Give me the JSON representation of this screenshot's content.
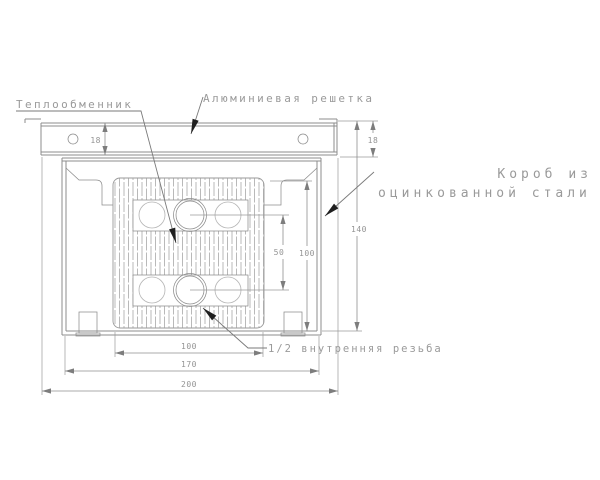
{
  "drawing": {
    "labels": {
      "heat_exchanger": "Теплообменник",
      "aluminum_grille": "Алюминиевая решетка",
      "steel_box_line1": "Короб из",
      "steel_box_line2": "оцинкованной стали",
      "thread": "1/2 внутренняя резьба"
    },
    "dimensions": {
      "grille_height_left": "18",
      "grille_height_right": "18",
      "total_height": "140",
      "inner_depth": "100",
      "pipe_spacing": "50",
      "block_width": "100",
      "box_width": "170",
      "total_width": "200"
    },
    "colors": {
      "line": "#8c8c8c",
      "light_line": "#b4b4b4",
      "text": "#9a9a9a",
      "leader_arrow": "#1f1f1f",
      "background": "#ffffff"
    }
  }
}
